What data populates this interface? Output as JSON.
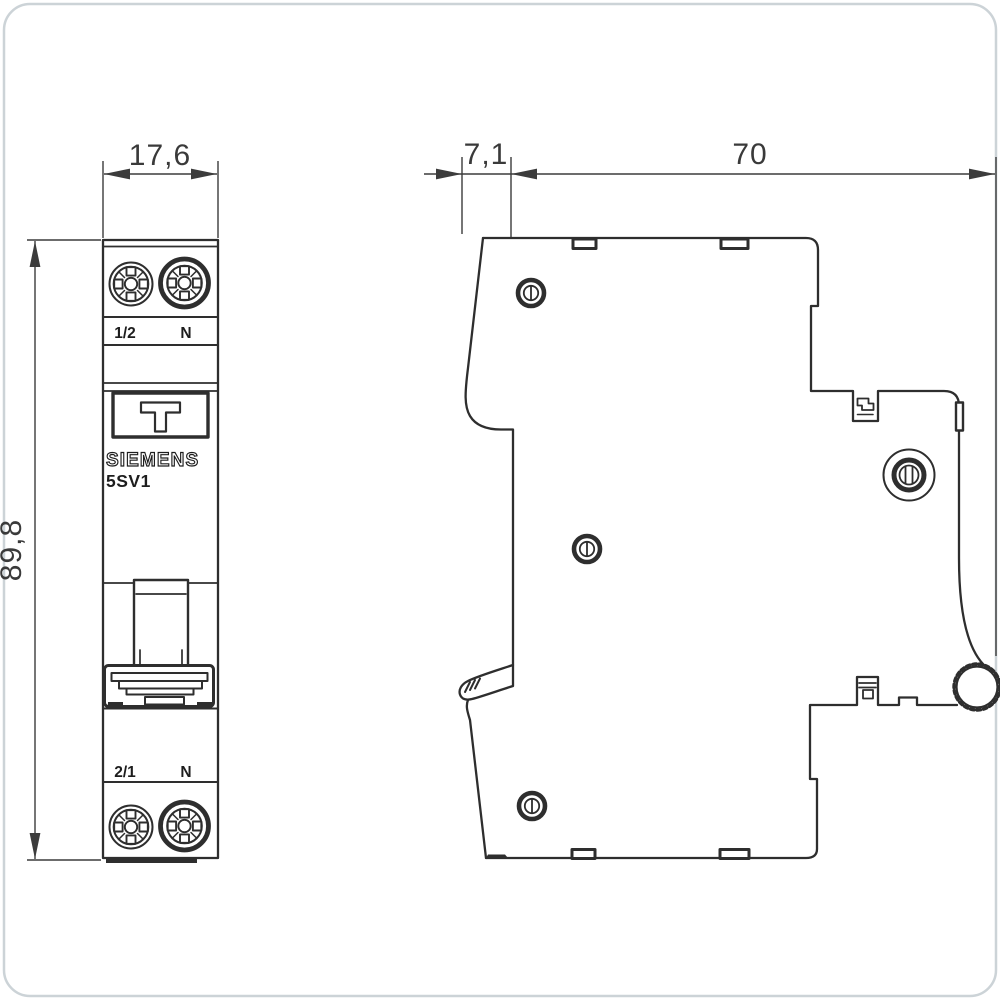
{
  "colors": {
    "background": "#ffffff",
    "frame_border": "#ccd3d7",
    "outline": "#2e2e2e",
    "dimension_lines": "#3c3c3c",
    "brand_letters_fill": "#ffffff",
    "dark_fill": "#2e2e2e"
  },
  "front_view": {
    "title": "front view",
    "width_dim": "17,6",
    "height_dim": "89,8",
    "top_terminal_left": "1/2",
    "top_terminal_right": "N",
    "bottom_terminal_left": "2/1",
    "bottom_terminal_right": "N",
    "brand": "SIEMENS",
    "model": "5SV1"
  },
  "side_view": {
    "title": "side view",
    "front_offset_dim": "7,1",
    "depth_dim": "70"
  },
  "icons": {
    "phillips_screw": "circle-with-cross-slots",
    "slotted_rivet": "bold-ring-with-vertical-slot",
    "knurled_wheel": "serrated-circle",
    "test_button": "T-shape",
    "din_clip": "stepped-hook"
  }
}
